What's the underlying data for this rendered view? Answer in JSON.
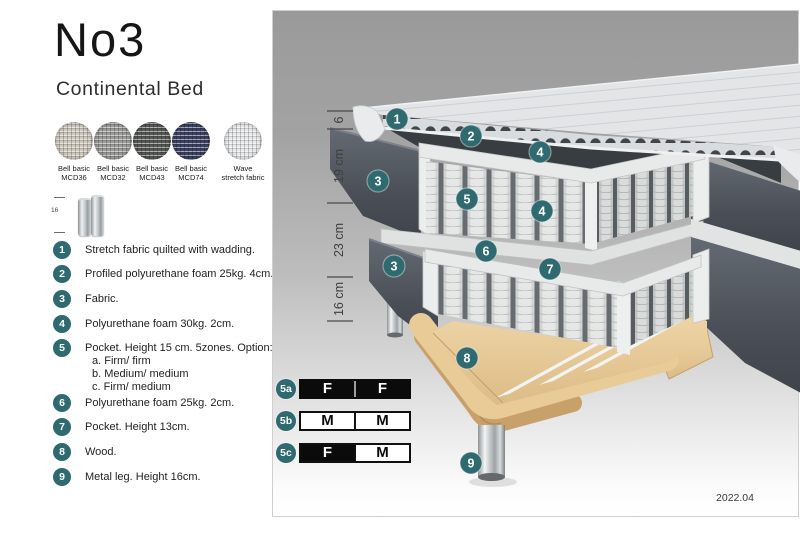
{
  "colors": {
    "accent_teal": "#2e6a70",
    "table_black": "#0b0b0b"
  },
  "header": {
    "title": "No3",
    "subtitle": "Continental Bed"
  },
  "swatches": [
    {
      "line1": "Bell basic",
      "line2": "MCD36",
      "color": "#cfc9be"
    },
    {
      "line1": "Bell basic",
      "line2": "MCD32",
      "color": "#9c9c9a"
    },
    {
      "line1": "Bell basic",
      "line2": "MCD43",
      "color": "#565956"
    },
    {
      "line1": "Bell basic",
      "line2": "MCD74",
      "color": "#3c4263"
    },
    {
      "line1": "Wave",
      "line2": "stretch fabric",
      "color": "#e7e9eb"
    }
  ],
  "leg_icon": {
    "dimension": "16"
  },
  "legend": [
    {
      "num": "1",
      "text": "Stretch fabric quilted with wadding."
    },
    {
      "num": "2",
      "text": "Profiled polyurethane foam 25kg. 4cm."
    },
    {
      "num": "3",
      "text": "Fabric."
    },
    {
      "num": "4",
      "text": "Polyurethane foam 30kg. 2cm."
    },
    {
      "num": "5",
      "text": "Pocket. Height 15 cm. 5zones. Option:",
      "options": [
        "a. Firm/ firm",
        "b. Medium/ medium",
        "c. Firm/ medium"
      ]
    },
    {
      "num": "6",
      "text": "Polyurethane foam 25kg. 2cm."
    },
    {
      "num": "7",
      "text": "Pocket. Height 13cm."
    },
    {
      "num": "8",
      "text": "Wood."
    },
    {
      "num": "9",
      "text": "Metal leg. Height 16cm."
    }
  ],
  "diagram": {
    "dimensions": [
      {
        "label": "6"
      },
      {
        "label": "19 cm"
      },
      {
        "label": "23 cm"
      },
      {
        "label": "16 cm"
      }
    ],
    "callouts": [
      {
        "label": "1"
      },
      {
        "label": "2"
      },
      {
        "label": "4"
      },
      {
        "label": "3"
      },
      {
        "label": "5"
      },
      {
        "label": "4"
      },
      {
        "label": "6"
      },
      {
        "label": "7"
      },
      {
        "label": "3"
      },
      {
        "label": "8"
      },
      {
        "label": "9"
      }
    ],
    "firmness_rows": [
      {
        "id": "5a",
        "cells": [
          {
            "text": "F"
          },
          {
            "text": "F"
          }
        ]
      },
      {
        "id": "5b",
        "cells": [
          {
            "text": "M"
          },
          {
            "text": "M"
          }
        ]
      },
      {
        "id": "5c",
        "cells": [
          {
            "text": "F"
          },
          {
            "text": "M"
          }
        ]
      }
    ],
    "version": "2022.04"
  }
}
